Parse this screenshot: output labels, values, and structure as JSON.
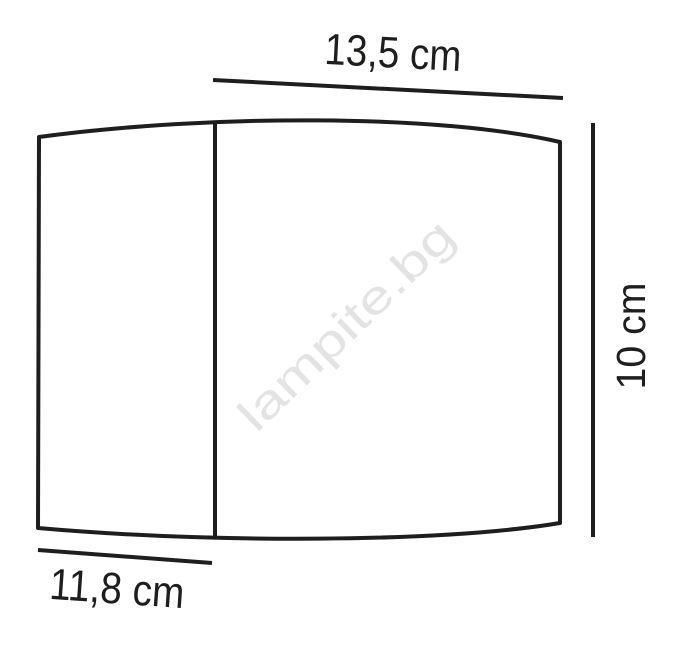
{
  "diagram": {
    "watermark": "lampite.bg",
    "dimensions": {
      "top_width": "13,5 cm",
      "right_height": "10 cm",
      "bottom_width": "11,8 cm"
    },
    "colors": {
      "line": "#1e1e1c",
      "label_text": "#1e1e1c",
      "watermark": "#e3e3e3",
      "background": "#ffffff"
    }
  }
}
